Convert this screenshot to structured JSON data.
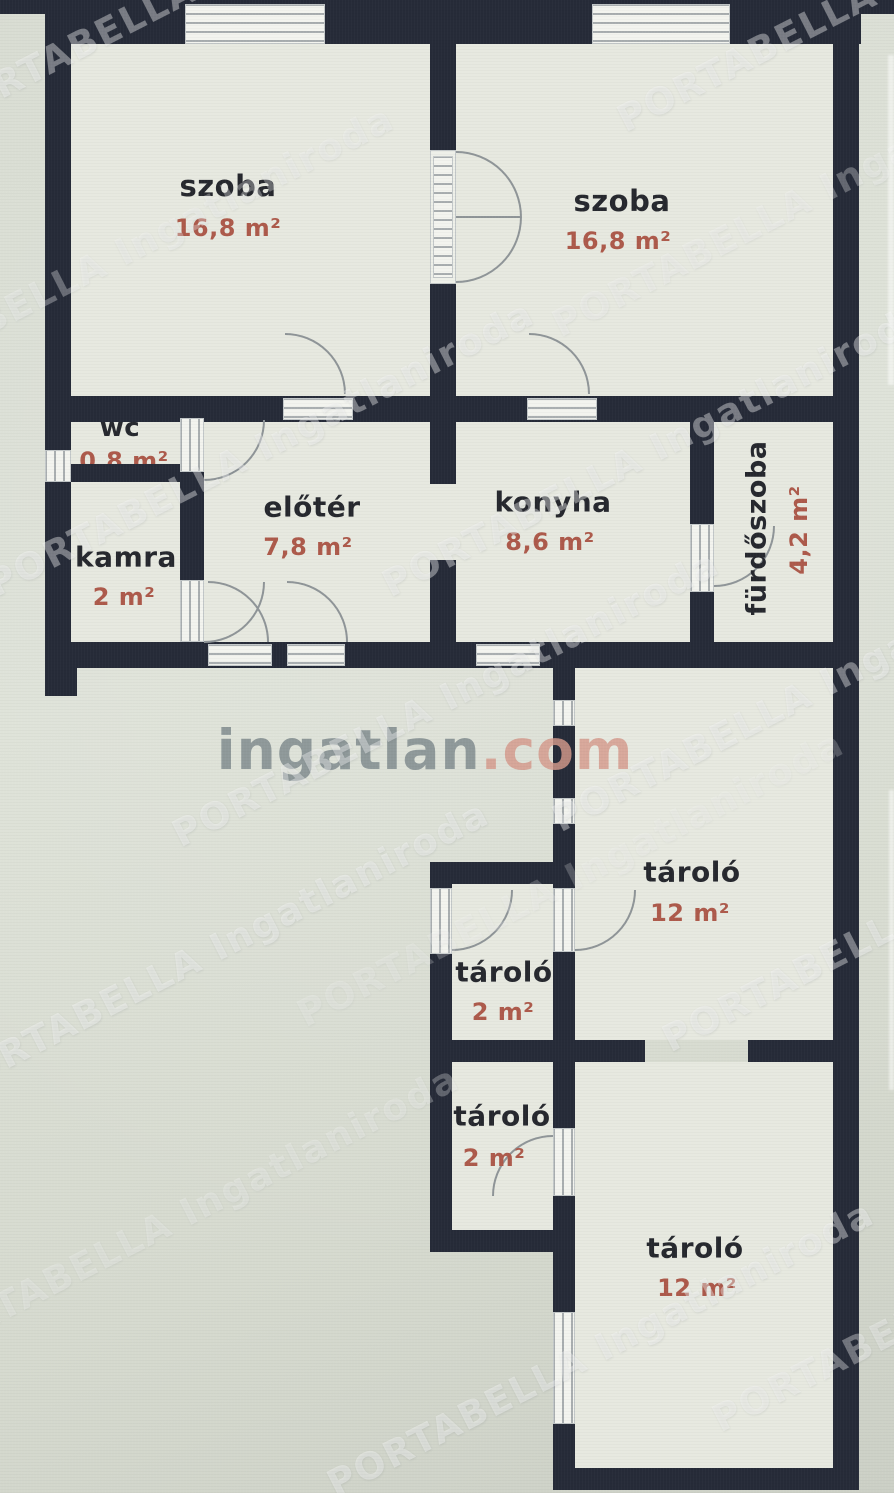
{
  "plan": {
    "site_logo": {
      "name": "ingatlan.com",
      "part_main": "ingatlan",
      "part_tld": ".com"
    },
    "watermark_text": "PORTABELLA Ingatlaniroda",
    "rooms": [
      {
        "id": "szoba-1",
        "name": "szoba",
        "area": "16,8 m²"
      },
      {
        "id": "szoba-2",
        "name": "szoba",
        "area": "16,8 m²"
      },
      {
        "id": "wc",
        "name": "wc",
        "area": "0,8 m²"
      },
      {
        "id": "kamra",
        "name": "kamra",
        "area": "2 m²"
      },
      {
        "id": "eloter",
        "name": "előtér",
        "area": "7,8 m²"
      },
      {
        "id": "konyha",
        "name": "konyha",
        "area": "8,6 m²"
      },
      {
        "id": "furdoszoba",
        "name": "fürdőszoba",
        "area": "4,2 m²"
      },
      {
        "id": "tarolo-felso-nagy",
        "name": "tároló",
        "area": "12 m²"
      },
      {
        "id": "tarolo-felso-kis",
        "name": "tároló",
        "area": "2 m²"
      },
      {
        "id": "tarolo-also-kis",
        "name": "tároló",
        "area": "2 m²"
      },
      {
        "id": "tarolo-also-nagy",
        "name": "tároló",
        "area": "12 m²"
      }
    ],
    "colors": {
      "wall": "#262b38",
      "room_name_text": "#26282e",
      "area_text": "#ad5a4b",
      "background": "#dadfd5",
      "logo_gray": "#7e8a8d",
      "logo_salmon": "#d59a8c"
    }
  }
}
